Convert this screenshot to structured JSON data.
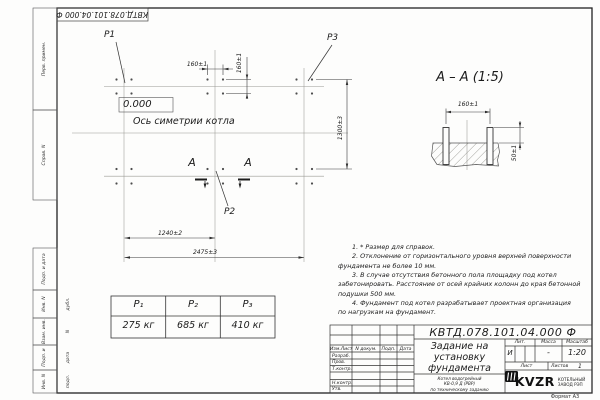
{
  "frame": {
    "top_stamp": "КВТД.078.101.04.000 Ф",
    "format_label": "Формат А3",
    "sidebar_items": [
      "Перв. примен.",
      "Справ. N",
      "Подп. и дата",
      "Инв. N дубл.",
      "Взам. инв. N",
      "Подп. и дата",
      "Инв. N подл."
    ]
  },
  "plan": {
    "p1_label": "P1",
    "p2_label": "P2",
    "p3_label": "P3",
    "elevation": "0.000",
    "axis_caption": "Ось симетрии котла",
    "section_letter_left": "А",
    "section_letter_right": "А",
    "dim_bolt_x": "160±1",
    "dim_bolt_y": "160±1",
    "dim_1240": "1240±2",
    "dim_2475": "2475±3",
    "dim_1300": "1300±3"
  },
  "section": {
    "title": "А – А (1:5)",
    "dim_160": "160±1",
    "dim_50": "50±1"
  },
  "notes": {
    "lines": [
      {
        "text": "1. * Размер для справок."
      },
      {
        "text": "2. Отклонение от горизонтального уровня верхней поверхности"
      },
      {
        "text": "фундамента не более 10 мм."
      },
      {
        "text": "3. В случае отсутствия бетонного пола площадку под котел"
      },
      {
        "text": "забетонировать. Расстояние от осей крайних колонн до края бетонной"
      },
      {
        "text": "подушки 500 мм."
      },
      {
        "text": "4. Фундамент под котел разрабатывает проектная организация"
      },
      {
        "text": "по нагрузкам на фундамент."
      }
    ]
  },
  "load_table": {
    "headers": [
      "P₁",
      "P₂",
      "P₃"
    ],
    "values": [
      "275 кг",
      "685 кг",
      "410 кг"
    ]
  },
  "title_block": {
    "doc_number": "КВТД.078.101.04.000 Ф",
    "title_lines": [
      "Задание на",
      "установку",
      "фундамента"
    ],
    "subject_lines": [
      "Котел водогрейный",
      "КВ-0,9 Д (РВР)",
      "по техническому заданию"
    ],
    "header_cells": [
      "Изм.Лист",
      "N докум.",
      "Подп.",
      "Дата"
    ],
    "signature_rows": [
      "Разраб.",
      "Пров.",
      "Т.контр.",
      "",
      "Н.контр.",
      "Утв."
    ],
    "lit_label": "Лит.",
    "lit_value": "И",
    "mass_label": "Масса",
    "mass_value": "-",
    "scale_label": "Масштаб",
    "scale_value": "1:20",
    "sheet_label": "Лист",
    "sheets_label": "Листов",
    "sheets_value": "1",
    "logo_text": "KVZR",
    "company_lines": [
      "КОТЕЛЬНЫЙ",
      "ЗАВОД РЭП"
    ]
  }
}
